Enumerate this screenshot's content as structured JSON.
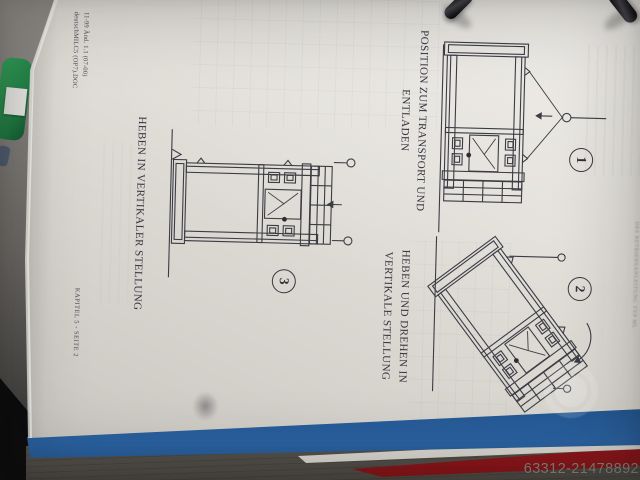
{
  "photo_overlay": {
    "watermark_id": "63312-21478892"
  },
  "document": {
    "figures": [
      {
        "number": "1",
        "caption": "POSITION ZUM TRANSPORT UND\nENTLADEN"
      },
      {
        "number": "2",
        "caption": "HEBEN UND DREHEN IN\nVERTIKALE STELLUNG"
      },
      {
        "number": "3",
        "caption": "HEBEN IN VERTIKALER STELLUNG"
      }
    ],
    "footer": {
      "revision_line1": "11-99 Änd. 1.1 (07-00)",
      "revision_line2": "deutschMILC5 (OP7).DOC",
      "chapter": "KAPITEL 5 - SEITE 2"
    },
    "edge_bleed_text": "DES BETRIEBSANLEITUNG TYP ML"
  },
  "colors": {
    "binder_blue": "#2f70b4",
    "binder_red": "#b22025",
    "binder_green": "#2a9152",
    "paper": "#e2dfd9",
    "ink": "#3c3c45",
    "watermark_gray": "#87837a"
  }
}
